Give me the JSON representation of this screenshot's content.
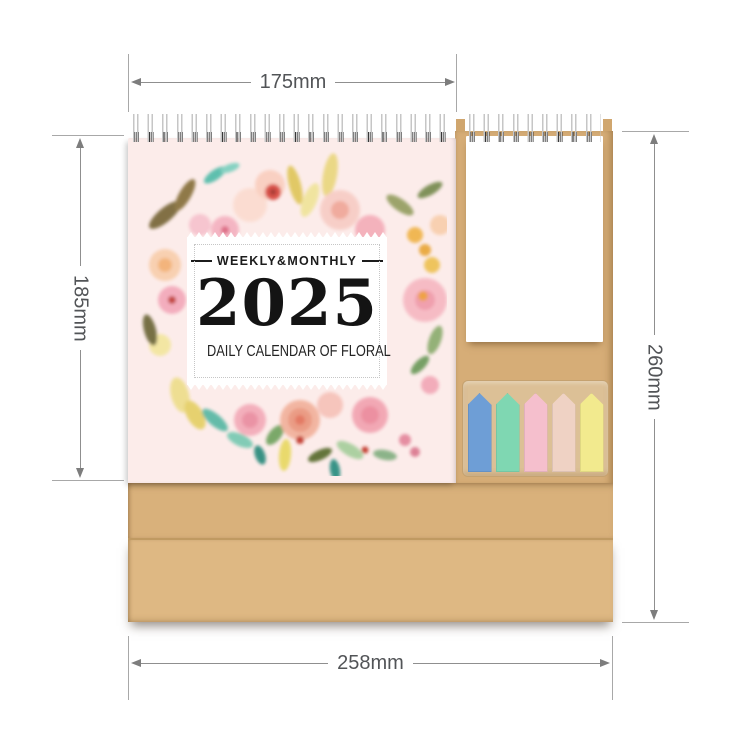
{
  "product": {
    "cover": {
      "tagline": "WEEKLY&MONTHLY",
      "year": "2025",
      "subtitle": "DAILY CALENDAR OF FLORAL"
    },
    "index_tab_colors": [
      "#6E9ED6",
      "#7FD7B2",
      "#F5BFCD",
      "#EFD2C4",
      "#F2EA8E"
    ],
    "colors": {
      "kraft_panel": "#D6AD77",
      "kraft_base_upper": "#D9B17B",
      "kraft_base_lower": "#DEB883",
      "tabs_holder": "#DCC096",
      "cover_page_pink": "#FCECEA",
      "notepad_white": "#FFFFFF",
      "wire_binding": "#383838"
    }
  },
  "dimension_annotations": {
    "top_width": "175mm",
    "page_height": "185mm",
    "total_height": "260mm",
    "total_width": "258mm"
  }
}
